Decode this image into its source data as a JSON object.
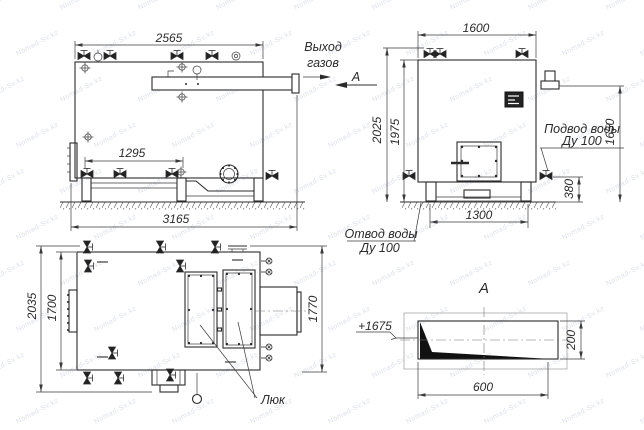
{
  "drawing": {
    "labels": {
      "gas_outlet_line1": "Выход",
      "gas_outlet_line2": "газов",
      "section_mark": "А",
      "section_view_title": "А",
      "water_supply_line1": "Подвод воды",
      "water_supply_line2": "Ду 100",
      "water_drain_line1": "Отвод воды",
      "water_drain_line2": "Ду 100",
      "hatch_label": "Люк",
      "elevation_mark": "+1675"
    },
    "dims": {
      "front": {
        "width": "2565",
        "span": "1295",
        "overall": "3165"
      },
      "side": {
        "width": "1600",
        "height_outer": "2025",
        "height_inner": "1975",
        "drain": "380",
        "base": "1300",
        "outlet": "1650"
      },
      "top": {
        "outer": "2035",
        "inner": "1700",
        "right": "1770"
      },
      "section": {
        "width": "600",
        "height": "200"
      }
    },
    "watermark": {
      "text": "Nomad-Sv.kz"
    },
    "colors": {
      "line": "#2b2b2b",
      "watermark": "#8c98af"
    }
  }
}
